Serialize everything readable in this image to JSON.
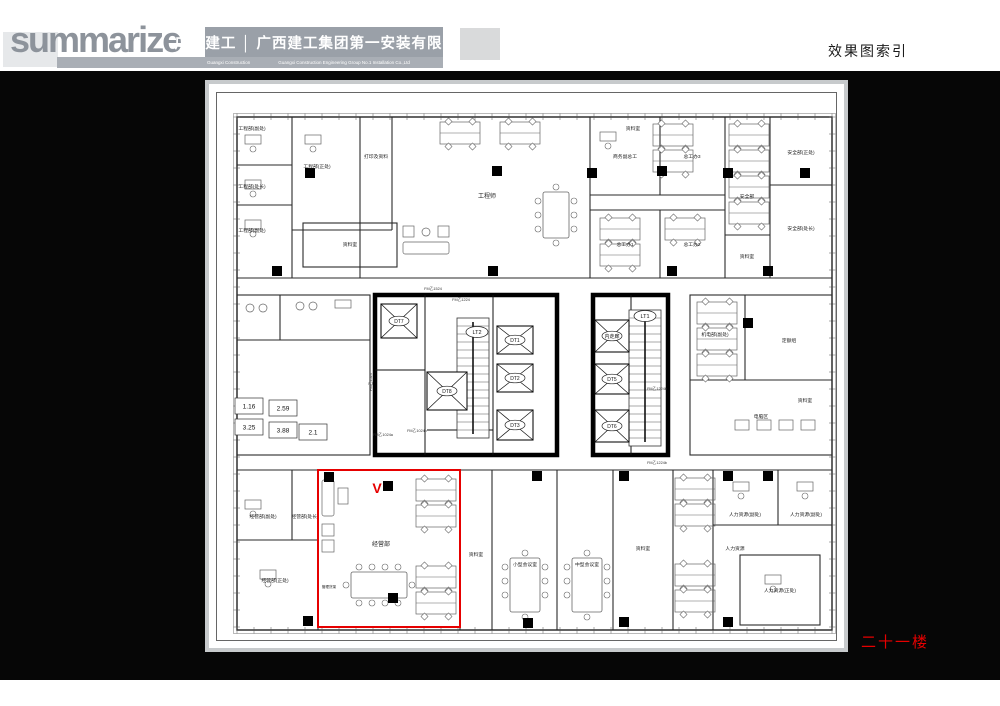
{
  "header": {
    "logo": "summarize",
    "company_cn": "广西建工 │ 广西建工集团第一安装有限公司",
    "company_en_left": "Guangxi Construction",
    "company_en_right": "Guangxi Construction Engineering Group No.1 Installation Co.,Ltd",
    "page_title": "效果图索引"
  },
  "floor_label": "二十一楼",
  "colors": {
    "accent_red": "#e60000",
    "header_gray": "#9aa0a8",
    "sheet_border": "#c7cacc"
  },
  "plan": {
    "rooms": [
      {
        "t": "工程部(副处)",
        "x": 47,
        "y": 50
      },
      {
        "t": "工程部(处长)",
        "x": 47,
        "y": 108
      },
      {
        "t": "工程部(副处)",
        "x": 47,
        "y": 152
      },
      {
        "t": "工程部(正处)",
        "x": 112,
        "y": 88
      },
      {
        "t": "打印及资料",
        "x": 171,
        "y": 78
      },
      {
        "t": "资料室",
        "x": 145,
        "y": 166
      },
      {
        "t": "工程师",
        "x": 282,
        "y": 118,
        "s": 6
      },
      {
        "t": "资料室",
        "x": 428,
        "y": 50
      },
      {
        "t": "商务副总工",
        "x": 420,
        "y": 78
      },
      {
        "t": "总工办3",
        "x": 487,
        "y": 78
      },
      {
        "t": "总工办1",
        "x": 420,
        "y": 166
      },
      {
        "t": "总工办2",
        "x": 487,
        "y": 166
      },
      {
        "t": "安全部",
        "x": 542,
        "y": 118
      },
      {
        "t": "安全部(正处)",
        "x": 596,
        "y": 74
      },
      {
        "t": "安全部(处长)",
        "x": 596,
        "y": 150
      },
      {
        "t": "资料室",
        "x": 542,
        "y": 178
      },
      {
        "t": "机电部(副处)",
        "x": 510,
        "y": 256
      },
      {
        "t": "定额组",
        "x": 584,
        "y": 262
      },
      {
        "t": "资料室",
        "x": 600,
        "y": 322
      },
      {
        "t": "电脑区",
        "x": 556,
        "y": 338
      },
      {
        "t": "经营部(副处)",
        "x": 58,
        "y": 438
      },
      {
        "t": "经营部(处长)",
        "x": 100,
        "y": 438
      },
      {
        "t": "经营部(正处)",
        "x": 70,
        "y": 502
      },
      {
        "t": "管理货架",
        "x": 124,
        "y": 508,
        "s": 3.6
      },
      {
        "t": "经营部",
        "x": 176,
        "y": 466,
        "s": 6
      },
      {
        "t": "资料室",
        "x": 271,
        "y": 476
      },
      {
        "t": "小型会议室",
        "x": 320,
        "y": 486
      },
      {
        "t": "中型会议室",
        "x": 382,
        "y": 486
      },
      {
        "t": "资料室",
        "x": 438,
        "y": 470
      },
      {
        "t": "人力资源(副处)",
        "x": 540,
        "y": 436
      },
      {
        "t": "人力资源(副处)",
        "x": 601,
        "y": 436
      },
      {
        "t": "人力资源",
        "x": 530,
        "y": 470
      },
      {
        "t": "人力资源(正处)",
        "x": 575,
        "y": 512
      }
    ],
    "elevators": [
      {
        "id": "DT7",
        "x": 176,
        "y": 224,
        "w": 36,
        "h": 34
      },
      {
        "id": "DT8",
        "x": 222,
        "y": 292,
        "w": 40,
        "h": 38
      },
      {
        "id": "DT1",
        "x": 292,
        "y": 246,
        "w": 36,
        "h": 28
      },
      {
        "id": "DT2",
        "x": 292,
        "y": 284,
        "w": 36,
        "h": 28
      },
      {
        "id": "DT3",
        "x": 292,
        "y": 330,
        "w": 36,
        "h": 30
      },
      {
        "id": "内走廊",
        "x": 390,
        "y": 240,
        "w": 34,
        "h": 32
      },
      {
        "id": "DT5",
        "x": 390,
        "y": 284,
        "w": 34,
        "h": 30
      },
      {
        "id": "DT6",
        "x": 390,
        "y": 330,
        "w": 34,
        "h": 32
      }
    ],
    "stairs": [
      {
        "id": "LT2",
        "x": 252,
        "y": 238,
        "w": 32,
        "h": 120,
        "lx": 272,
        "ly": 252
      },
      {
        "id": "LT1",
        "x": 424,
        "y": 230,
        "w": 32,
        "h": 136,
        "lx": 440,
        "ly": 236
      }
    ],
    "door_tags": [
      {
        "t": "FM乙1524",
        "x": 228,
        "y": 210
      },
      {
        "t": "FM乙1224",
        "x": 256,
        "y": 221
      },
      {
        "t": "FM乙1024b",
        "x": 212,
        "y": 352
      },
      {
        "t": "FM乙1024a",
        "x": 178,
        "y": 356
      },
      {
        "t": "FM乙1524",
        "x": 167,
        "y": 302,
        "r": -90
      },
      {
        "t": "FM乙1224b",
        "x": 452,
        "y": 310
      },
      {
        "t": "FM乙1224b",
        "x": 452,
        "y": 384
      }
    ],
    "toilet_numbers": [
      {
        "t": "1.16",
        "x": 44,
        "y": 326
      },
      {
        "t": "2.59",
        "x": 78,
        "y": 328
      },
      {
        "t": "3.25",
        "x": 44,
        "y": 347
      },
      {
        "t": "3.88",
        "x": 78,
        "y": 350
      },
      {
        "t": "2.1",
        "x": 108,
        "y": 352
      }
    ],
    "highlight": {
      "x": 113,
      "y": 390,
      "w": 142,
      "h": 157,
      "marker": "V",
      "mx": 172,
      "my": 413
    }
  }
}
